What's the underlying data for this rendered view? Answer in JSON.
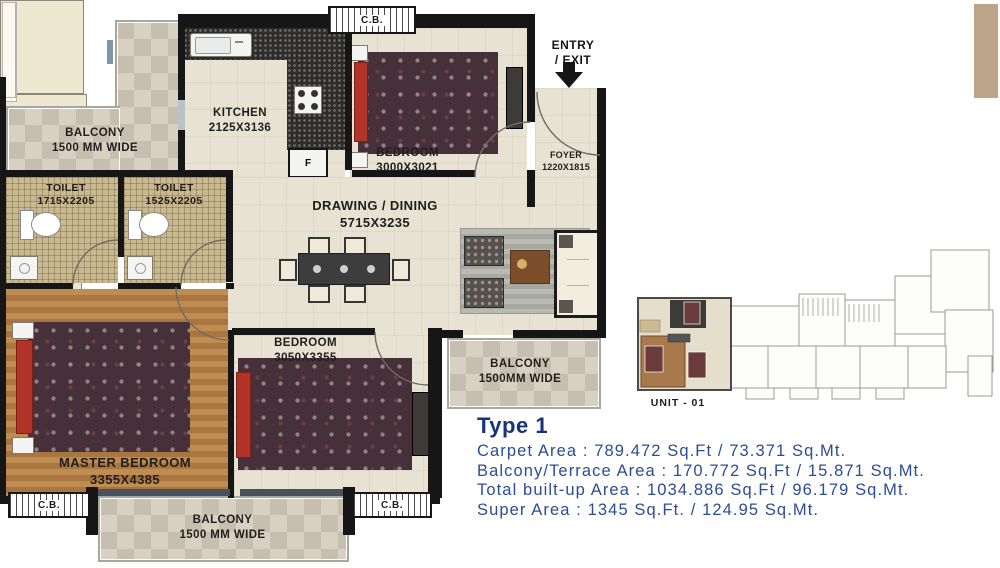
{
  "rooms": {
    "balcony_top_left": {
      "label": "BALCONY",
      "dim": "1500 MM WIDE"
    },
    "kitchen": {
      "label": "KITCHEN",
      "dim": "2125X3136"
    },
    "toilet_left": {
      "label": "TOILET",
      "dim": "1715X2205"
    },
    "toilet_right": {
      "label": "TOILET",
      "dim": "1525X2205"
    },
    "bedroom_top": {
      "label": "BEDROOM",
      "dim": "3000X3021"
    },
    "drawing_dining": {
      "label": "DRAWING / DINING",
      "dim": "5715X3235"
    },
    "foyer": {
      "label": "FOYER",
      "dim": "1220X1815"
    },
    "master_bedroom": {
      "label": "MASTER BEDROOM",
      "dim": "3355X4385"
    },
    "bedroom_bottom": {
      "label": "BEDROOM",
      "dim": "3050X3355"
    },
    "balcony_right": {
      "label": "BALCONY",
      "dim": "1500MM WIDE"
    },
    "balcony_bottom": {
      "label": "BALCONY",
      "dim": "1500 MM WIDE"
    }
  },
  "annotations": {
    "entry_line1": "ENTRY",
    "entry_line2": "/ EXIT",
    "cb_top": "C.B.",
    "cb_bottom_left": "C.B.",
    "cb_bottom_right": "C.B.",
    "fridge": "F",
    "unit_label": "UNIT - 01"
  },
  "info": {
    "title": "Type 1",
    "lines": [
      "Carpet Area : 789.472 Sq.Ft / 73.371 Sq.Mt.",
      "Balcony/Terrace Area : 170.772 Sq.Ft / 15.871 Sq.Mt.",
      "Total built-up Area : 1034.886 Sq.Ft / 96.179 Sq.Mt.",
      "Super Area : 1345 Sq.Ft. / 124.95 Sq.Mt."
    ],
    "colors": {
      "title_blue": "#14357e",
      "body_blue": "#2c4c97"
    }
  }
}
